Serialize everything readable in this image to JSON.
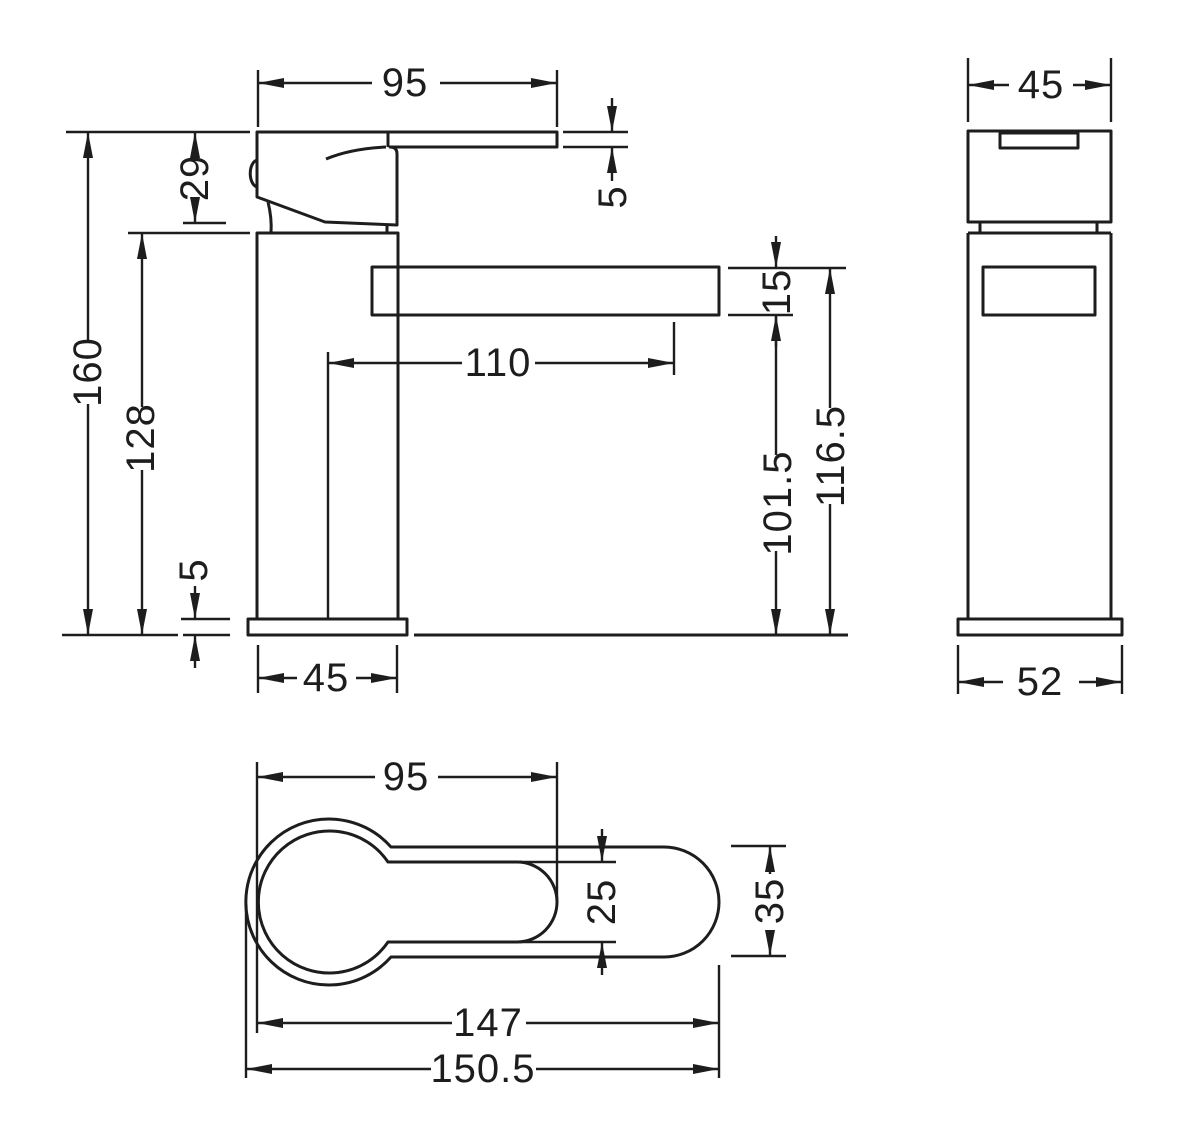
{
  "drawing": {
    "background": "#ffffff",
    "line_color": "#1d1d1d",
    "views": {
      "front": {
        "dims": {
          "handle_width": "95",
          "lever_thickness": "5",
          "head_height": "29",
          "overall_height": "160",
          "body_height": "128",
          "base_thickness": "5",
          "body_width": "45",
          "spout_reach": "110",
          "spout_thickness": "15",
          "spout_underside_height": "101.5",
          "spout_top_height": "116.5"
        }
      },
      "side": {
        "dims": {
          "body_depth": "45",
          "base_depth": "52"
        }
      },
      "top": {
        "dims": {
          "handle_length": "95",
          "handle_width": "25",
          "body_width": "35",
          "body_length": "147",
          "overall_length": "150.5"
        }
      }
    }
  }
}
